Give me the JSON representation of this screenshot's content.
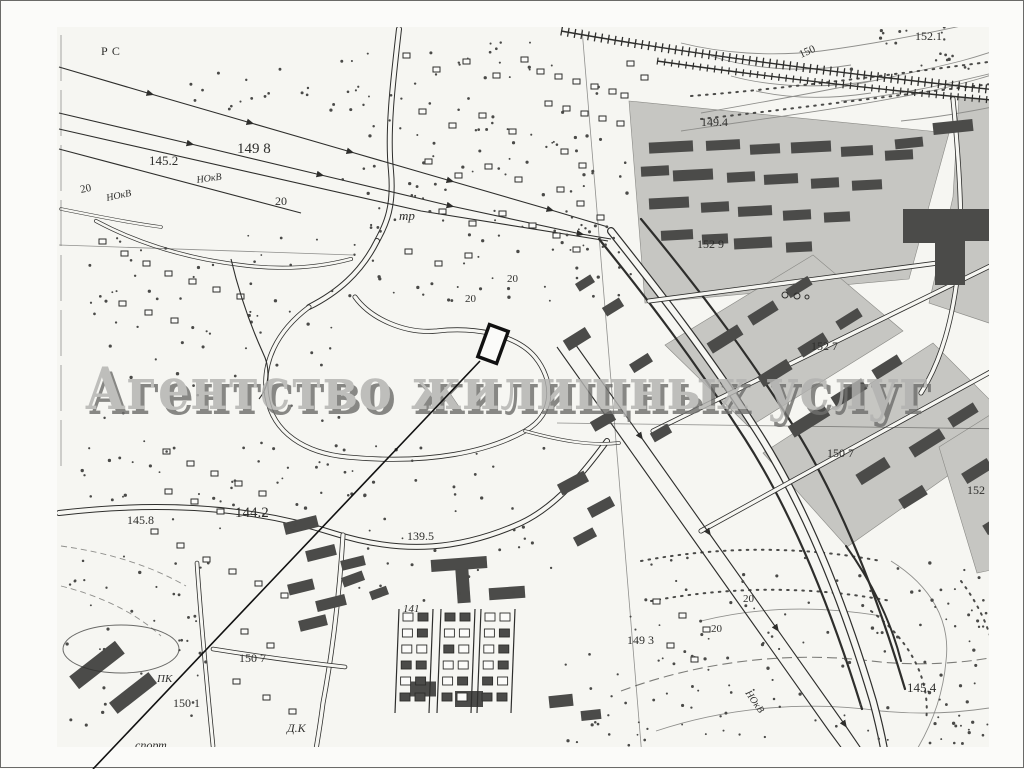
{
  "watermark": {
    "text": "Агентство жилищных услуг"
  },
  "colors": {
    "paper": "#fbfbf9",
    "map_tint": "#f6f6f2",
    "ink": "#2e2e2c",
    "shade": "#c6c6c2",
    "building": "#4b4b49",
    "contour": "#8f8f8c",
    "wm_front": "#b2b2b0",
    "wm_back": "#6f6f6d",
    "plot": "#111111"
  },
  "map": {
    "labels": [
      {
        "text": "РС",
        "x": 100,
        "y": 54,
        "size": 12,
        "ls": 4
      },
      {
        "text": "149 8",
        "x": 236,
        "y": 152,
        "size": 15
      },
      {
        "text": "145.2",
        "x": 148,
        "y": 164,
        "size": 13
      },
      {
        "text": "20",
        "x": 80,
        "y": 192,
        "size": 11,
        "rotate": -12
      },
      {
        "text": "НОкВ",
        "x": 106,
        "y": 200,
        "size": 10,
        "rotate": -12,
        "italic": true
      },
      {
        "text": "НОкВ",
        "x": 196,
        "y": 182,
        "size": 10,
        "rotate": -8,
        "italic": true
      },
      {
        "text": "20",
        "x": 274,
        "y": 204,
        "size": 12
      },
      {
        "text": "тр",
        "x": 398,
        "y": 219,
        "size": 13,
        "italic": true
      },
      {
        "text": "150",
        "x": 800,
        "y": 57,
        "size": 11,
        "rotate": -24
      },
      {
        "text": "152.1",
        "x": 914,
        "y": 39,
        "size": 12
      },
      {
        "text": "149.4",
        "x": 700,
        "y": 125,
        "size": 12
      },
      {
        "text": "152 9",
        "x": 696,
        "y": 247,
        "size": 12
      },
      {
        "text": "152 7",
        "x": 810,
        "y": 349,
        "size": 12
      },
      {
        "text": "150 7",
        "x": 826,
        "y": 456,
        "size": 12
      },
      {
        "text": "152",
        "x": 966,
        "y": 493,
        "size": 12
      },
      {
        "text": "20",
        "x": 506,
        "y": 281,
        "size": 11
      },
      {
        "text": "20",
        "x": 464,
        "y": 301,
        "size": 11
      },
      {
        "text": "145.8",
        "x": 126,
        "y": 523,
        "size": 12
      },
      {
        "text": "144.2",
        "x": 234,
        "y": 516,
        "size": 15
      },
      {
        "text": "139.5",
        "x": 406,
        "y": 539,
        "size": 12
      },
      {
        "text": "141",
        "x": 402,
        "y": 611,
        "size": 11,
        "italic": true
      },
      {
        "text": "150 7",
        "x": 238,
        "y": 661,
        "size": 12
      },
      {
        "text": "ПК",
        "x": 156,
        "y": 681,
        "size": 11,
        "italic": true
      },
      {
        "text": "150 1",
        "x": 172,
        "y": 706,
        "size": 12
      },
      {
        "text": "Д.К",
        "x": 286,
        "y": 731,
        "size": 12,
        "italic": true
      },
      {
        "text": "спорт",
        "x": 134,
        "y": 748,
        "size": 12,
        "italic": true
      },
      {
        "text": "149 3",
        "x": 626,
        "y": 643,
        "size": 12
      },
      {
        "text": "20",
        "x": 742,
        "y": 601,
        "size": 11
      },
      {
        "text": "20",
        "x": 710,
        "y": 631,
        "size": 11
      },
      {
        "text": "НОкВ",
        "x": 744,
        "y": 692,
        "size": 10,
        "rotate": 55,
        "italic": true
      },
      {
        "text": "145.4",
        "x": 906,
        "y": 691,
        "size": 13
      }
    ]
  }
}
